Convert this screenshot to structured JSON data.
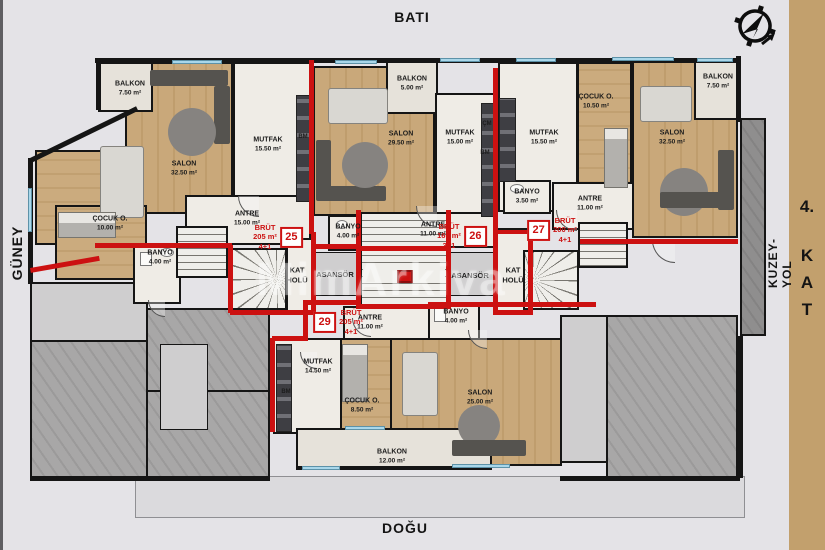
{
  "meta": {
    "bg": "#e4e3e7",
    "accent_red": "#cc1111",
    "sidebar_tan": "#c2a06d",
    "wood": "#c9a87a",
    "glass_blue": "#a9d7ea"
  },
  "directions": {
    "top": "BATI",
    "bottom": "DOĞU",
    "left": "GÜNEY",
    "right": "KUZEY-YOL"
  },
  "floor_badge": {
    "number": "4.",
    "letters": [
      "K",
      "A",
      "T"
    ]
  },
  "watermark": "MimArkiva",
  "core": {
    "kat_holu_left": {
      "line1": "KAT",
      "line2": "HOLÜ"
    },
    "kat_holu_right": {
      "line1": "KAT",
      "line2": "HOLÜ"
    },
    "asansor_left": "ASANSÖR",
    "asansor_right": "ASANSÖR"
  },
  "units": [
    {
      "no": "25",
      "brut_label": "BRÜT",
      "area": "205 m²",
      "plan": "4+1"
    },
    {
      "no": "26",
      "brut_label": "BRÜT",
      "area": "160 m²",
      "plan": "3+1"
    },
    {
      "no": "27",
      "brut_label": "BRÜT",
      "area": "200 m²",
      "plan": "4+1"
    },
    {
      "no": "29",
      "brut_label": "BRÜT",
      "area": "205 m²",
      "plan": "4+1"
    }
  ],
  "rooms": {
    "a25_balkon": {
      "name": "BALKON",
      "area": "7.50 m²"
    },
    "a25_salon": {
      "name": "SALON",
      "area": "32.50 m²"
    },
    "a25_mutfak": {
      "name": "MUTFAK",
      "area": "15.50 m²"
    },
    "a25_cocuk": {
      "name": "ÇOCUK O.",
      "area": "10.00 m²"
    },
    "a25_banyo": {
      "name": "BANYO",
      "area": "4.00 m²"
    },
    "a25_antre": {
      "name": "ANTRE",
      "area": "15.00 m²"
    },
    "a26_balkon": {
      "name": "BALKON",
      "area": "5.00 m²"
    },
    "a26_salon": {
      "name": "SALON",
      "area": "29.50 m²"
    },
    "a26_mutfak": {
      "name": "MUTFAK",
      "area": "15.00 m²"
    },
    "a26_antre": {
      "name": "ANTRE",
      "area": "11.00 m²"
    },
    "a26_banyo": {
      "name": "BANYO",
      "area": "4.00 m²"
    },
    "a27_mutfak": {
      "name": "MUTFAK",
      "area": "15.50 m²"
    },
    "a27_cocuk": {
      "name": "ÇOCUK O.",
      "area": "10.50 m²"
    },
    "a27_salon": {
      "name": "SALON",
      "area": "32.50 m²"
    },
    "a27_balkon": {
      "name": "BALKON",
      "area": "7.50 m²"
    },
    "a27_banyo": {
      "name": "BANYO",
      "area": "3.50 m²"
    },
    "a27_antre": {
      "name": "ANTRE",
      "area": "11.00 m²"
    },
    "a29_antre": {
      "name": "ANTRE",
      "area": "11.00 m²"
    },
    "a29_banyo": {
      "name": "BANYO",
      "area": "4.00 m²"
    },
    "a29_mutfak": {
      "name": "MUTFAK",
      "area": "14.50 m²"
    },
    "a29_cocuk": {
      "name": "ÇOCUK O.",
      "area": "8.50 m²"
    },
    "a29_salon": {
      "name": "SALON",
      "area": "25.00 m²"
    },
    "a29_balkon": {
      "name": "BALKON",
      "area": "12.00 m²"
    }
  },
  "tags": {
    "cm26": "ÇM",
    "bm26": "BM",
    "bm25": "BM",
    "bm29": "BM"
  }
}
